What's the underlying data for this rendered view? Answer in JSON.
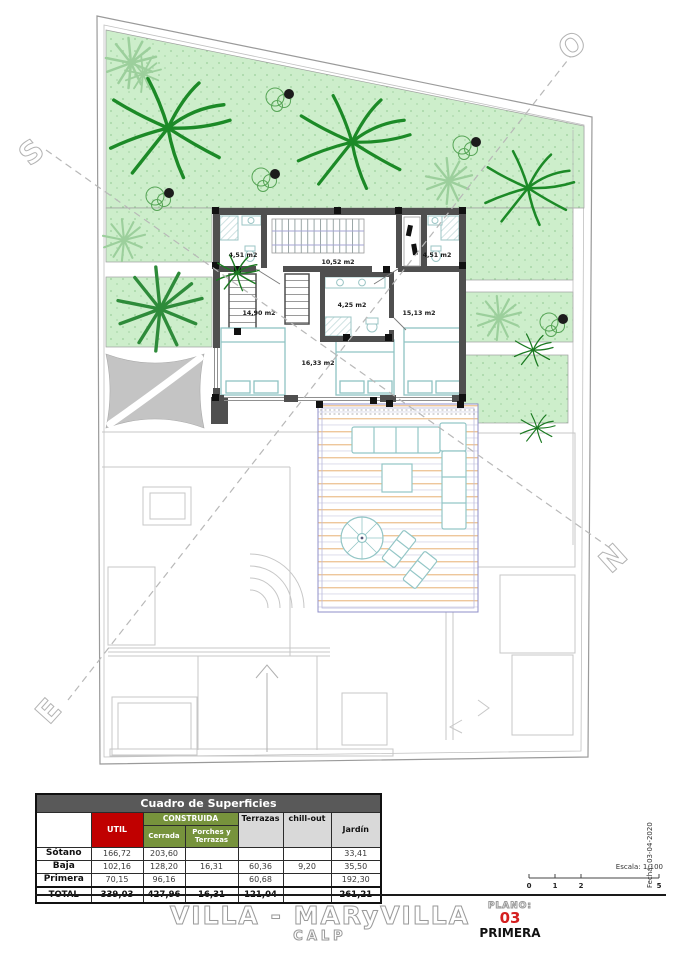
{
  "compass": {
    "s": "S",
    "o": "O",
    "e": "E",
    "n": "N"
  },
  "plan": {
    "rooms": {
      "bath_left": "4,51 m2",
      "hall": "10,52 m2",
      "bath_right": "4,51 m2",
      "bed_left": "14,90 m2",
      "bath_center": "4,25 m2",
      "bed_right": "15,13 m2",
      "bed_center": "16,33 m2"
    }
  },
  "table": {
    "title": "Cuadro de Superficies",
    "columns": {
      "util": "UTIL",
      "construida": "CONSTRUIDA",
      "cerrada": "Cerrada",
      "porches": "Porches y Terrazas",
      "terrazas": "Terrazas",
      "chillout": "chill-out",
      "jardin": "Jardín"
    },
    "rows": [
      {
        "name": "Sótano",
        "util": "166,72",
        "cerrada": "203,60",
        "porches": "",
        "terrazas": "",
        "chillout": "",
        "jardin": "33,41"
      },
      {
        "name": "Baja",
        "util": "102,16",
        "cerrada": "128,20",
        "porches": "16,31",
        "terrazas": "60,36",
        "chillout": "9,20",
        "jardin": "35,50"
      },
      {
        "name": "Primera",
        "util": "70,15",
        "cerrada": "96,16",
        "porches": "",
        "terrazas": "60,68",
        "chillout": "",
        "jardin": "192,30"
      },
      {
        "name": "TOTAL",
        "util": "339,03",
        "cerrada": "427,96",
        "porches": "16,31",
        "terrazas": "121,04",
        "chillout": "",
        "jardin": "261,21"
      }
    ]
  },
  "titleblock": {
    "project": "VILLA - MARyVILLA",
    "location": "CALP",
    "plano_label": "PLANO:",
    "plano_number": "03",
    "plano_name": "PRIMERA",
    "escala": "Escala: 1/100",
    "fecha": "Fecha: 03-04-2020",
    "scale_ticks": [
      "0",
      "1",
      "2",
      "5"
    ]
  },
  "colors": {
    "util_red": "#C00000",
    "construida_olive": "#77933C",
    "table_header_gray": "#595959",
    "light_gray": "#D9D9D9",
    "garden_green": "#CDEECB",
    "palm_green": "#1C8A27",
    "plano_red": "#D41F1F"
  }
}
